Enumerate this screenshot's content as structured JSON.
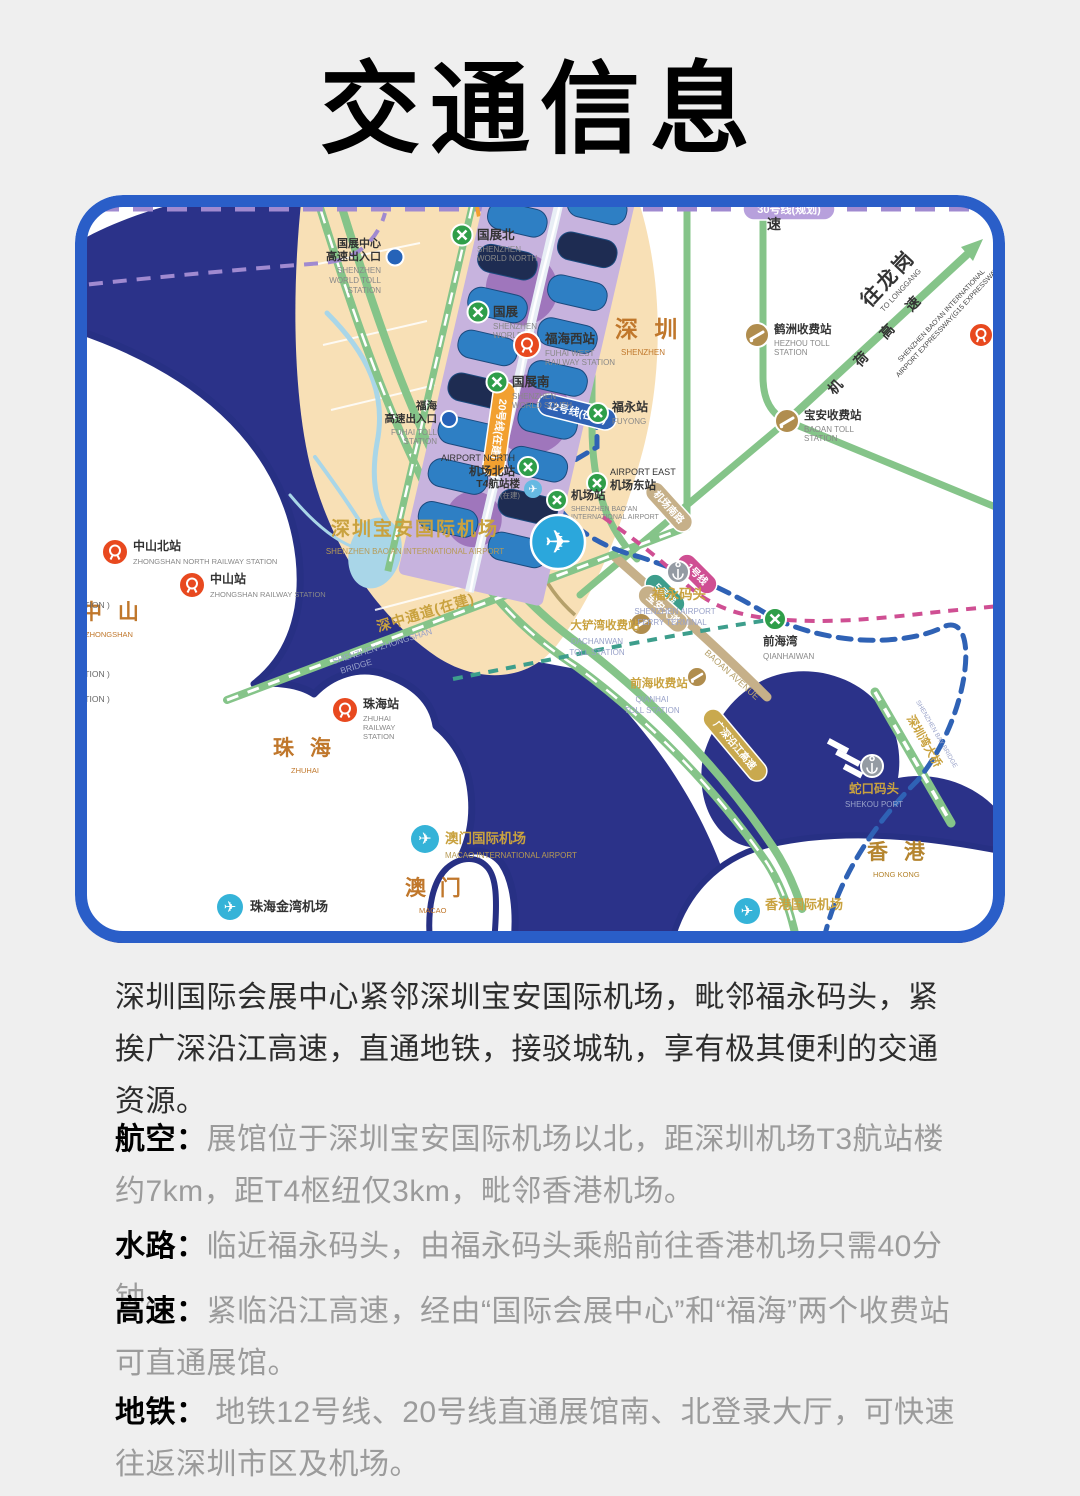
{
  "page": {
    "title": "交通信息"
  },
  "intro": "深圳国际会展中心紧邻深圳宝安国际机场，毗邻福永码头，紧挨广深沿江高速，直通地铁，接驳城轨，享有极其便利的交通资源。",
  "sections": [
    {
      "label": "航空：",
      "text": "展馆位于深圳宝安国际机场以北，距深圳机场T3航站楼约7km，距T4枢纽仅3km，毗邻香港机场。"
    },
    {
      "label": "水路：",
      "text": "临近福永码头，由福永码头乘船前往香港机场只需40分钟。"
    },
    {
      "label": "高速：",
      "text": "紧临沿江高速，经由“国际会展中心”和“福海”两个收费站可直通展馆。"
    },
    {
      "label": "地铁：",
      "text": " 地铁12号线、20号线直通展馆南、北登录大厅，可快速往返深圳市区及机场。"
    }
  ],
  "map": {
    "colors": {
      "sea": "#2b3289",
      "land": "#ffffff",
      "tan": "#f8e0b6",
      "road_green": "#85c489",
      "gold": "#c9a23f",
      "region": "#c0772b",
      "metro_green": "#2f9e49",
      "rail_red": "#e8491f",
      "toll_tan": "#b08d4e",
      "line12_blue": "#2f62b5",
      "line20_orange": "#f2a030",
      "line30_purple": "#b7a0dc",
      "frame_blue": "#2a5ec8"
    },
    "regions": {
      "shenzhen": {
        "zh": "深 圳",
        "en": "SHENZHEN"
      },
      "zhongshan": {
        "zh": "中 山",
        "en": "ZHONGSHAN"
      },
      "zhuhai": {
        "zh": "珠 海",
        "en": "ZHUHAI"
      },
      "macao": {
        "zh": "澳 门",
        "en": "MACAO"
      },
      "hongkong": {
        "zh": "香 港",
        "en": "HONG KONG"
      }
    },
    "world_toll": {
      "zh1": "国展中心",
      "zh2": "高速出入口",
      "en1": "SHENZHEN",
      "en2": "WORLD TOLL",
      "en3": "STATION"
    },
    "fuhai_toll": {
      "zh1": "福海",
      "zh2": "高速出入口",
      "en1": "FUHAI TOLL",
      "en2": "STATION"
    },
    "world_north": {
      "zh": "国展北",
      "en1": "SHENZHEN",
      "en2": "WORLD NORTH"
    },
    "world": {
      "zh": "国展",
      "en1": "SHENZHEN",
      "en2": "WORLD"
    },
    "world_south": {
      "zh": "国展南",
      "en1": "SHENZHEN",
      "en2": "WORLD SOUTH"
    },
    "fuhai_west": {
      "zh": "福海西站",
      "en1": "FUHAI WEST",
      "en2": "RAILWAY STATION"
    },
    "fuyong": {
      "zh": "福永站",
      "en1": "FUYONG"
    },
    "airport_north": {
      "en1": "AIRPORT NORTH",
      "zh": "机场北站"
    },
    "t4": {
      "zh": "T4航站楼",
      "sub": "(在建)"
    },
    "airport_east": {
      "en1": "AIRPORT EAST",
      "zh": "机场东站"
    },
    "airport_station": {
      "zh": "机场站",
      "en1": "SHENZHEN BAO'AN",
      "en2": "INTERNATIONAL AIRPORT"
    },
    "baoan_airport": {
      "zh": "深圳宝安国际机场",
      "en": "SHENZHEN BAO'AN INTERNATIONAL AIRPORT"
    },
    "fuyong_ferry": {
      "zh": "福永码头",
      "en1": "SHENZHEN AIRPORT",
      "en2": "FERRY TERMINAL"
    },
    "szzs_bridge": {
      "zh": "深中通道(在建)",
      "en1": "SHENZHEN-ZHONGSHAN",
      "en2": "BRIDGE"
    },
    "dachanwan": {
      "zh": "大铲湾收费站",
      "en1": "DACHANWAN",
      "en2": "TOLL STATION"
    },
    "qianhai_toll": {
      "zh": "前海收费站",
      "en1": "QIANHAI",
      "en2": "TOLL STATION"
    },
    "qianhaiwan": {
      "zh": "前海湾",
      "en1": "QIANHAIWAN"
    },
    "hezhou": {
      "zh": "鹤洲收费站",
      "en1": "HEZHOU TOLL",
      "en2": "STATION"
    },
    "baoan_toll": {
      "zh": "宝安收费站",
      "en1": "BAOAN TOLL",
      "en2": "STATION"
    },
    "longgang": {
      "zh": "往龙岗",
      "en": "TO LONGGANG"
    },
    "jihe": {
      "zh": "机 荷 高 速"
    },
    "g15": {
      "en1": "SHENZHEN BAO'AN INTERNATIONAL",
      "en2": "AIRPORT EXPRESSWAY(G15 EXPRESSWAY)"
    },
    "su_partial": "速",
    "zhongshan_north": {
      "zh": "中山北站",
      "en1": "ZHONGSHAN NORTH RAILWAY STATION"
    },
    "zhongshan_station": {
      "zh": "中山站",
      "en1": "ZHONGSHAN RAILWAY STATION"
    },
    "zhuhai_station": {
      "zh": "珠海站",
      "en1": "ZHUHAI",
      "en2": "RAILWAY",
      "en3": "STATION"
    },
    "shenzhen_north": {
      "zh": "深圳北站",
      "en1": "SHENZHEN NORTH"
    },
    "shekou": {
      "zh": "蛇口码头",
      "en1": "SHEKOU PORT"
    },
    "sz_bay_bridge": {
      "zh": "深圳湾大桥",
      "en": "SHENZHEN BAY BRIDGE"
    },
    "macao_airport": {
      "zh": "澳门国际机场",
      "en": "MACAO INTERNATIONAL AIRPORT"
    },
    "zhuhai_jinwan": {
      "zh": "珠海金湾机场"
    },
    "hk_airport": {
      "zh": "香港国际机场"
    },
    "line30": "30号线(规划)",
    "line12": "12号线(在建)",
    "line20": "20号线(在建)",
    "line1": "1号线",
    "line5": "5号线",
    "baoan_ave": {
      "zh": "宝安大道",
      "en": "BAOAN AVENUE"
    },
    "airport_south_rd": "机场南路",
    "yanjiang": "广深沿江高速",
    "construction_partial": "UCTION )"
  }
}
